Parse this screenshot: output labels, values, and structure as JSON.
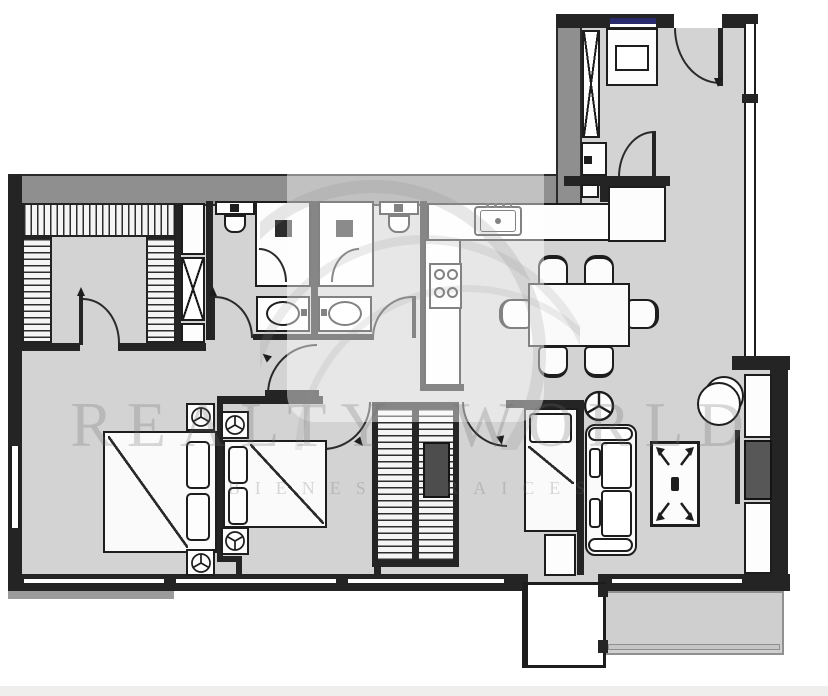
{
  "watermark": {
    "brand": "REALTY WORLD",
    "tagline": "BIENES RAICES"
  },
  "palette": {
    "background": "#ffffff",
    "floor": "#d3d3d3",
    "wall_dark": "#242424",
    "wall_gray": "#8f8f8f",
    "balcony": "#cfcfcf",
    "window_accent_blue": "#2a2a6e",
    "furniture_fill": "#fafafa",
    "cabinet_dark": "#4d4d4d",
    "watermark_gray": "#8a8a8a"
  }
}
